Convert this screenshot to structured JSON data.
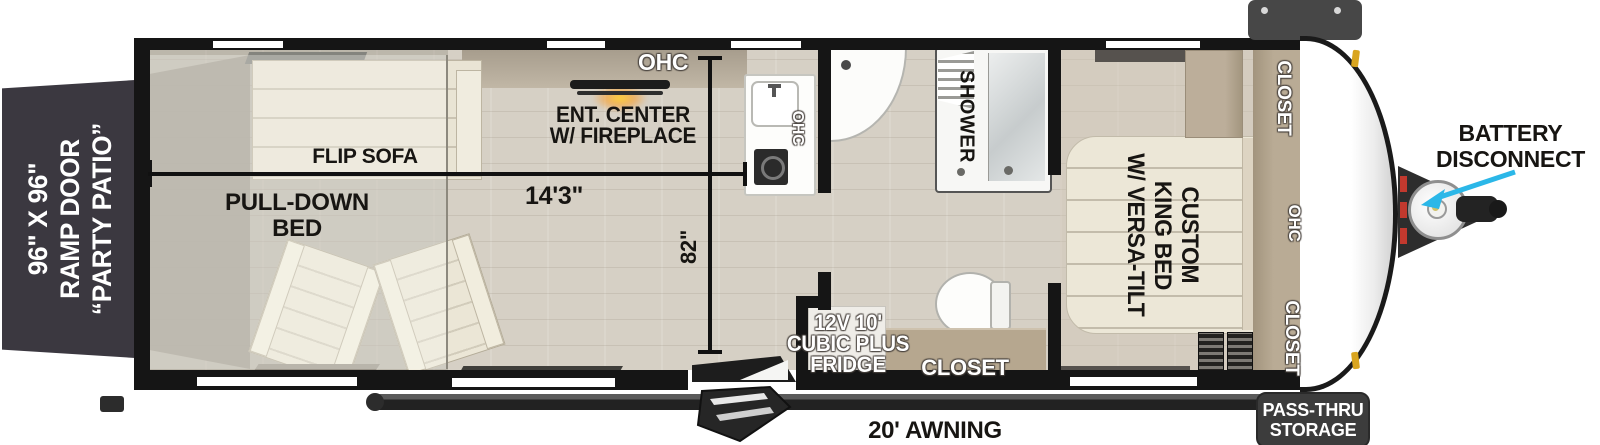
{
  "labels": {
    "ramp_door": [
      "96\" X 96\"",
      "RAMP DOOR",
      "“PARTY PATIO”"
    ],
    "flip_sofa": "FLIP SOFA",
    "pull_down_bed": [
      "PULL-DOWN",
      "BED"
    ],
    "ohc_living": "OHC",
    "ent_center": [
      "ENT. CENTER",
      "W/ FIREPLACE"
    ],
    "dim_length": "14'3\"",
    "dim_width": "82\"",
    "ohc_kitchen": "OHC",
    "shower": "SHOWER",
    "fridge": [
      "12V 10'",
      "CUBIC PLUS",
      "FRIDGE"
    ],
    "closet_bath": "CLOSET",
    "king_bed": [
      "CUSTOM",
      "KING BED",
      "W/ VERSA-TILT"
    ],
    "closet_front_top": "CLOSET",
    "ohc_bedroom": "OHC",
    "closet_front_bottom": "CLOSET",
    "pass_thru_storage": [
      "PASS-THRU",
      "STORAGE"
    ],
    "battery_disconnect": [
      "BATTERY",
      "DISCONNECT"
    ],
    "awning": "20' AWNING"
  },
  "colors": {
    "wall": "#151515",
    "ramp_door": "#3b3840",
    "floor": "#d6d0c5",
    "closet_tan": "#b5a791",
    "arrow_cyan": "#2bb7e8",
    "fireplace_glow": "#ffb020",
    "marker_amber": "#d9a520"
  }
}
